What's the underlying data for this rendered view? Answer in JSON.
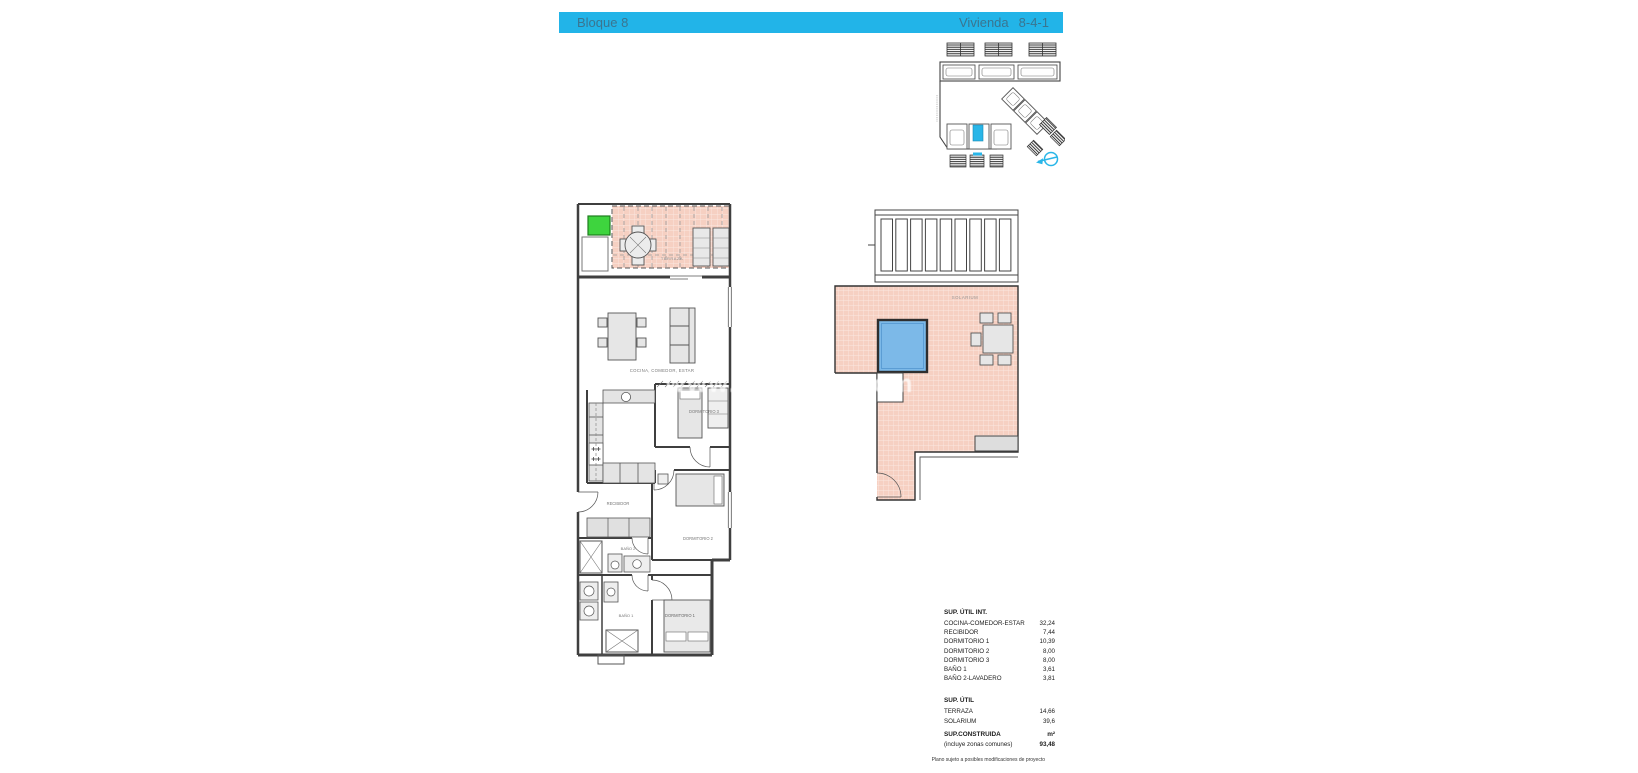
{
  "header": {
    "block": "Bloque 8",
    "unit_label": "Vivienda",
    "unit_value": "8-4-1"
  },
  "watermark": "www.·········n.com",
  "main_plan": {
    "labels": {
      "terraza": "TERRAZA",
      "cocina": "COCINA, COMEDOR, ESTAR",
      "recibidor": "RECIBIDOR",
      "dormitorio1": "DORMITORIO 1",
      "dormitorio2": "DORMITORIO 2",
      "dormitorio3": "DORMITORIO 3",
      "bano1": "BAÑO 1",
      "bano2": "BAÑO 2"
    }
  },
  "solarium_plan": {
    "label": "SOLARIUM"
  },
  "areas_table": {
    "section1_title": "SUP. ÚTIL INT.",
    "section1_rows": [
      {
        "label": "COCINA-COMEDOR-ESTAR",
        "value": "32,24"
      },
      {
        "label": "RECIBIDOR",
        "value": "7,44"
      },
      {
        "label": "DORMITORIO 1",
        "value": "10,39"
      },
      {
        "label": "DORMITORIO 2",
        "value": "8,00"
      },
      {
        "label": "DORMITORIO 3",
        "value": "8,00"
      },
      {
        "label": "BAÑO 1",
        "value": "3,61"
      },
      {
        "label": "BAÑO 2-LAVADERO",
        "value": "3,81"
      }
    ],
    "section2_title": "SUP. ÚTIL",
    "section2_rows": [
      {
        "label": "TERRAZA",
        "value": "14,66"
      },
      {
        "label": "SOLARIUM",
        "value": "39,6"
      }
    ],
    "section3_title": "SUP.CONSTRUIDA",
    "section3_unit": "m²",
    "section3_sub": "(incluye zonas comunes)",
    "section3_value": "93,48",
    "footnote": "Plano sujeto a posibles modificaciones de proyecto"
  },
  "colors": {
    "header_bg": "#22b4e8",
    "header_text": "#3a7590",
    "tile_pink": "#f6d0c2",
    "pool_blue": "#7cb9e8",
    "highlight_green": "#3ed43e",
    "plan_cyan": "#29b6e8"
  }
}
